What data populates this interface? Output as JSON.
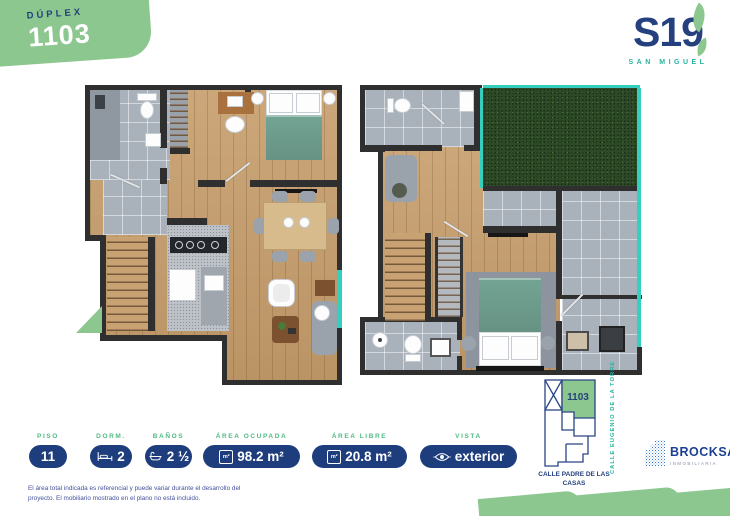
{
  "badge": {
    "label": "DÚPLEX",
    "number": "1103"
  },
  "logo": {
    "text": "S19",
    "subtitle": "SAN MIGUEL"
  },
  "stats": {
    "area_icon": "m²",
    "items": [
      {
        "label": "PISO",
        "value": "11"
      },
      {
        "label": "DORM.",
        "value": "2"
      },
      {
        "label": "BAÑOS",
        "value": "2 ½"
      },
      {
        "label": "ÁREA OCUPADA",
        "value": "98.2 m²"
      },
      {
        "label": "ÁREA LIBRE",
        "value": "20.8 m²"
      },
      {
        "label": "VISTA",
        "value": "exterior"
      }
    ]
  },
  "location_map": {
    "unit": "1103",
    "street_vertical": "CALLE EUGENIO DE LA TORRE",
    "street_bottom": "CALLE PADRE DE LAS CASAS"
  },
  "developer": {
    "name": "BROCKSA",
    "tagline": "INMOBILIARIA"
  },
  "disclaimer": "El área total indicada es referencial y puede variar durante el desarrollo del proyecto. El mobiliario mostrado en el plano no está incluido.",
  "colors": {
    "green": "#8cc78f",
    "navy": "#1e3d7d",
    "teal": "#35cfc0",
    "label_green": "#4fba82"
  }
}
